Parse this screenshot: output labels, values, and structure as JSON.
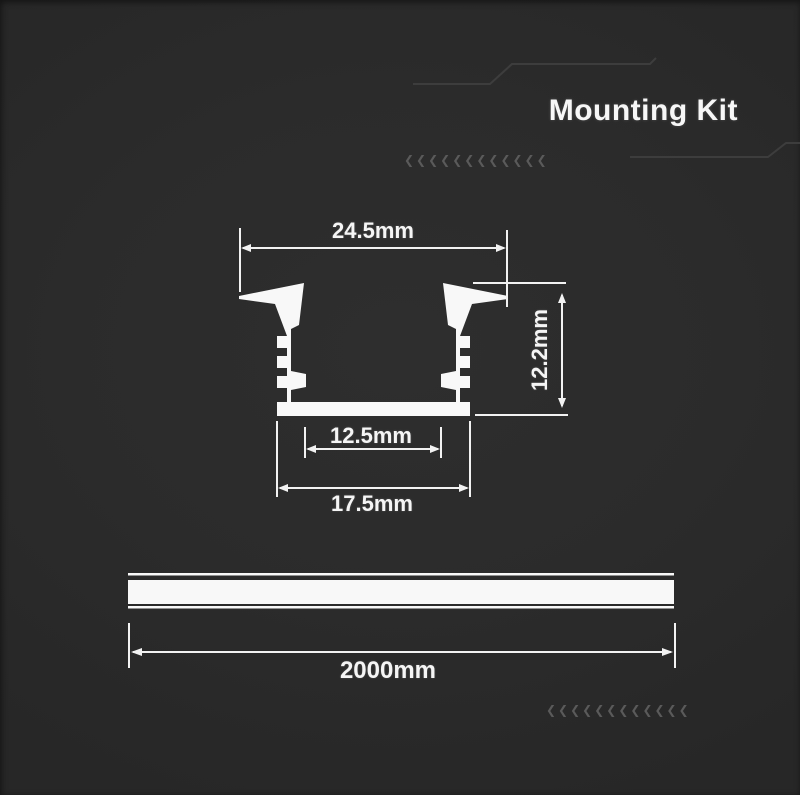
{
  "header": {
    "title": "Mounting Kit"
  },
  "colors": {
    "background": "#2b2b2b",
    "drawing": "#ffffff",
    "circuit_trace": "#3d3d3d",
    "chevron": "#5a5a5a"
  },
  "cross_section": {
    "description": "recessed aluminium LED profile cross-section",
    "dimensions": {
      "top_width": "24.5mm",
      "height": "12.2mm",
      "inner_width": "12.5mm",
      "base_width": "17.5mm"
    }
  },
  "profile_bar": {
    "description": "profile side view",
    "length": "2000mm"
  },
  "decor": {
    "chevrons_top": "❮❮❮❮❮❮❮❮❮❮❮❮",
    "chevrons_bottom": "❮❮❮❮❮❮❮❮❮❮❮❮"
  }
}
